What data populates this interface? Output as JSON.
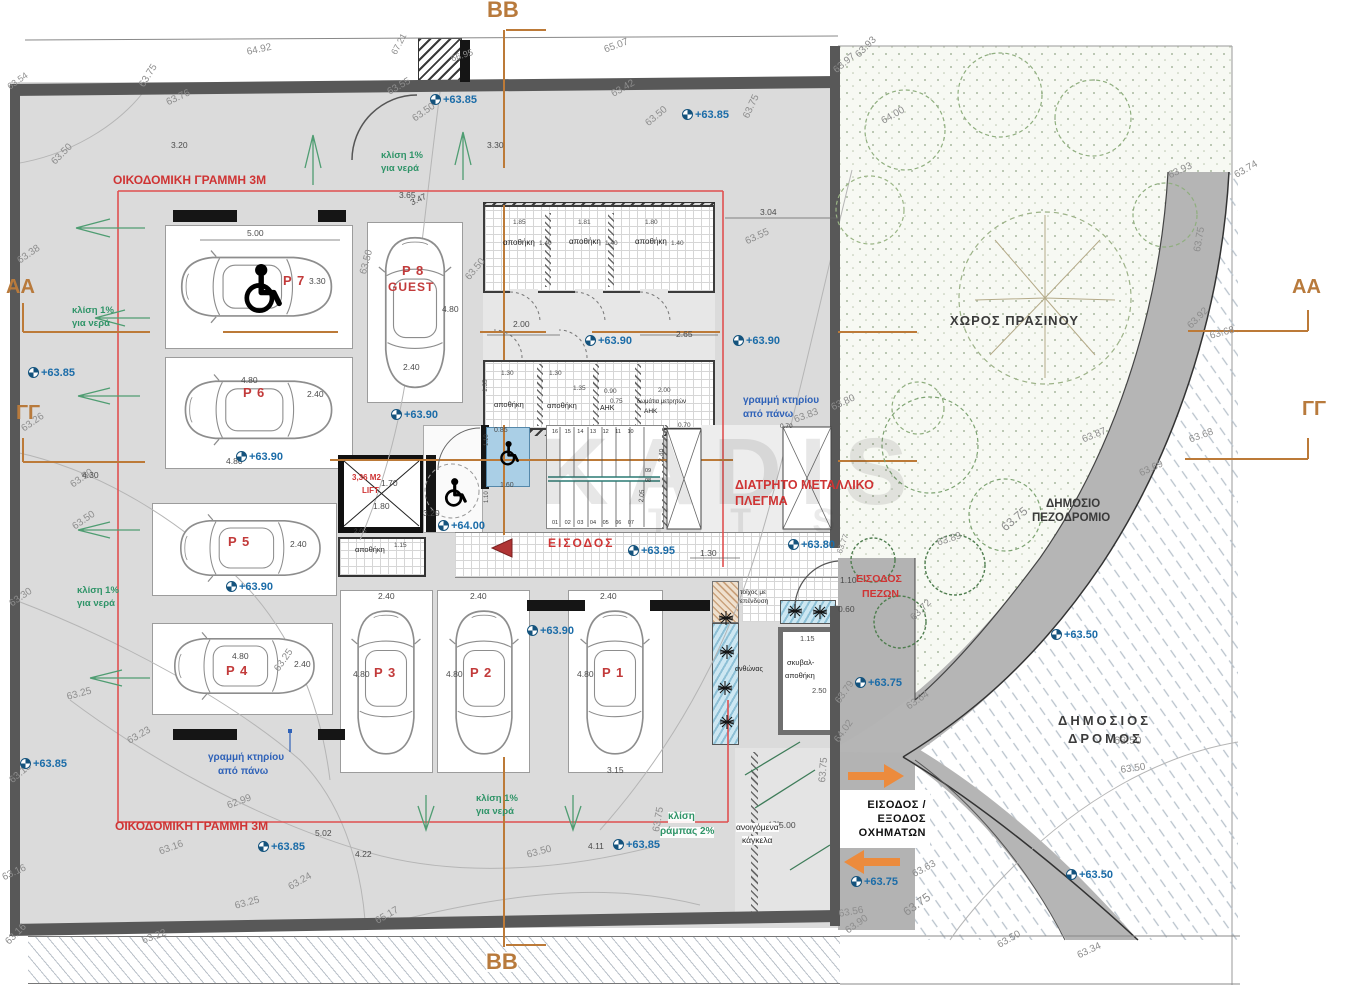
{
  "watermark": {
    "l1": "KADIS",
    "l2": "T T S"
  },
  "veh": [
    "ΕΙΣΟΔΟΣ /",
    "ΕΞΟΔΟΣ",
    "ΟΧΗΜΑΤΩΝ"
  ],
  "stairs": {
    "top": "16 15 14 13 12 11 10",
    "bottom": "01 02 03 04 05 06 07",
    "m1": "09",
    "m2": "08"
  },
  "sections": [
    {
      "t": "BB",
      "x": 487,
      "y": 0
    },
    {
      "t": "BB",
      "x": 486,
      "y": 952,
      "bg": 1
    },
    {
      "t": "ΑΑ",
      "x": 6,
      "y": 278,
      "fs": 20
    },
    {
      "t": "AA",
      "x": 1292,
      "y": 278,
      "fs": 20
    },
    {
      "t": "ΓΓ",
      "x": 16,
      "y": 404,
      "fs": 20
    },
    {
      "t": "ΓΓ",
      "x": 1302,
      "y": 400,
      "fs": 20
    }
  ],
  "areas": [
    {
      "t": "ΧΩΡΟΣ ΠΡΑΣΙΝΟΥ",
      "x": 950,
      "y": 314,
      "fs": 13,
      "ls": 1
    },
    {
      "t": "ΔΗΜΟΣΙΟ",
      "x": 1046,
      "y": 498,
      "fs": 11.5
    },
    {
      "t": "ΠΕΖΟΔΡΟΜΙΟ",
      "x": 1032,
      "y": 512,
      "fs": 11.5
    },
    {
      "t": "ΔΗΜΟΣΙΟΣ",
      "x": 1058,
      "y": 714,
      "fs": 13,
      "ls": 3
    },
    {
      "t": "ΔΡΟΜΟΣ",
      "x": 1068,
      "y": 732,
      "fs": 13,
      "ls": 3
    }
  ],
  "plabels": [
    {
      "t": "P 7",
      "x": 283,
      "y": 274
    },
    {
      "t": "P 6",
      "x": 243,
      "y": 386
    },
    {
      "t": "P 8",
      "x": 402,
      "y": 264
    },
    {
      "t": "GUEST",
      "x": 388,
      "y": 281,
      "fs": 12
    },
    {
      "t": "P 5",
      "x": 228,
      "y": 535
    },
    {
      "t": "P 4",
      "x": 226,
      "y": 664
    },
    {
      "t": "P 3",
      "x": 374,
      "y": 666
    },
    {
      "t": "P 2",
      "x": 470,
      "y": 666
    },
    {
      "t": "P 1",
      "x": 602,
      "y": 666
    }
  ],
  "red": [
    {
      "t": "ΟΙΚΟΔΟΜΙΚΗ ΓΡΑΜΜΗ 3Μ",
      "x": 113,
      "y": 174,
      "fs": 12
    },
    {
      "t": "ΟΙΚΟΔΟΜΙΚΗ ΓΡΑΜΜΗ 3Μ",
      "x": 115,
      "y": 820,
      "fs": 12
    },
    {
      "t": "ΔΙΑΤΡΗΤΟ ΜΕΤΑΛΛΙΚΟ",
      "x": 735,
      "y": 479,
      "fs": 12.5
    },
    {
      "t": "ΠΛΕΓΜΑ",
      "x": 735,
      "y": 495,
      "fs": 12.5
    },
    {
      "t": "ΕΙΣΟΔΟΣ",
      "x": 548,
      "y": 537,
      "fs": 12,
      "ls": 2
    },
    {
      "t": "ΕΙΣΟΔΟΣ",
      "x": 856,
      "y": 574,
      "fs": 10.5
    },
    {
      "t": "ΠΕΖΩΝ",
      "x": 862,
      "y": 589,
      "fs": 10.5
    },
    {
      "t": "3,36 M2",
      "x": 352,
      "y": 474,
      "fs": 8
    },
    {
      "t": "LIFT",
      "x": 362,
      "y": 487,
      "fs": 8
    }
  ],
  "blue": [
    {
      "t": "γραμμή κτηρίου",
      "x": 743,
      "y": 396
    },
    {
      "t": "από πάνω",
      "x": 743,
      "y": 410
    },
    {
      "t": "γραμμή κτηρίου",
      "x": 208,
      "y": 753
    },
    {
      "t": "από πάνω",
      "x": 218,
      "y": 767
    }
  ],
  "green": [
    {
      "t": "κλίση 1%",
      "x": 381,
      "y": 151
    },
    {
      "t": "για νερά",
      "x": 381,
      "y": 164
    },
    {
      "t": "κλίση 1%",
      "x": 72,
      "y": 306
    },
    {
      "t": "για νερά",
      "x": 72,
      "y": 319
    },
    {
      "t": "κλίση 1%",
      "x": 77,
      "y": 586
    },
    {
      "t": "για νερά",
      "x": 77,
      "y": 599
    },
    {
      "t": "κλίση 1%",
      "x": 476,
      "y": 794
    },
    {
      "t": "για νερά",
      "x": 476,
      "y": 807
    },
    {
      "t": "κλίση",
      "x": 668,
      "y": 812,
      "fs": 10,
      "bg": 1
    },
    {
      "t": "ράμπας 2%",
      "x": 660,
      "y": 827,
      "fs": 10,
      "bg": 1
    }
  ],
  "rooms": [
    {
      "t": "αποθήκη",
      "x": 503,
      "y": 239
    },
    {
      "t": "αποθήκη",
      "x": 569,
      "y": 238
    },
    {
      "t": "αποθήκη",
      "x": 635,
      "y": 238
    },
    {
      "t": "αποθήκη",
      "x": 494,
      "y": 401,
      "fs": 7.5
    },
    {
      "t": "αποθήκη",
      "x": 547,
      "y": 402,
      "fs": 7.5
    },
    {
      "t": "ΑΗΚ",
      "x": 600,
      "y": 405,
      "fs": 7
    },
    {
      "t": "δωμάτια μετρητών",
      "x": 637,
      "y": 399,
      "fs": 6
    },
    {
      "t": "ΑΗΚ",
      "x": 644,
      "y": 409,
      "fs": 6.5
    },
    {
      "t": "αποθήκη",
      "x": 355,
      "y": 546,
      "fs": 7.5
    },
    {
      "t": "σκυβαλ-",
      "x": 787,
      "y": 659,
      "fs": 7.5
    },
    {
      "t": "αποθήκη",
      "x": 785,
      "y": 672,
      "fs": 7.5
    },
    {
      "t": "ανθώνας",
      "x": 735,
      "y": 666,
      "fs": 7
    },
    {
      "t": "τοίχος με",
      "x": 740,
      "y": 590,
      "fs": 6.5
    },
    {
      "t": "επένδυση",
      "x": 740,
      "y": 599,
      "fs": 6.5
    },
    {
      "t": "ανοιγόμενα",
      "x": 736,
      "y": 823,
      "fs": 8.5,
      "bg": 1
    },
    {
      "t": "κάγκελα",
      "x": 742,
      "y": 836,
      "fs": 8.5,
      "bg": 1
    }
  ],
  "marks": [
    {
      "t": "+63.85",
      "x": 430,
      "y": 94
    },
    {
      "t": "+63.85",
      "x": 682,
      "y": 109
    },
    {
      "t": "+63.85",
      "x": 28,
      "y": 367
    },
    {
      "t": "+63.90",
      "x": 585,
      "y": 335
    },
    {
      "t": "+63.90",
      "x": 733,
      "y": 335
    },
    {
      "t": "+63.90",
      "x": 391,
      "y": 409
    },
    {
      "t": "+63.90",
      "x": 236,
      "y": 451
    },
    {
      "t": "+64.00",
      "x": 438,
      "y": 520
    },
    {
      "t": "+63.95",
      "x": 628,
      "y": 545
    },
    {
      "t": "+63.80",
      "x": 788,
      "y": 539
    },
    {
      "t": "+63.90",
      "x": 527,
      "y": 625
    },
    {
      "t": "+63.90",
      "x": 226,
      "y": 581
    },
    {
      "t": "+63.75",
      "x": 855,
      "y": 677
    },
    {
      "t": "+63.75",
      "x": 851,
      "y": 876
    },
    {
      "t": "+63.50",
      "x": 1051,
      "y": 629
    },
    {
      "t": "+63.50",
      "x": 1066,
      "y": 869
    },
    {
      "t": "+63.85",
      "x": 20,
      "y": 758
    },
    {
      "t": "+63.85",
      "x": 258,
      "y": 841
    },
    {
      "t": "+63.85",
      "x": 613,
      "y": 839
    }
  ],
  "gray": [
    {
      "t": "64.92",
      "x": 246,
      "y": 48,
      "r": -12
    },
    {
      "t": "65.07",
      "x": 603,
      "y": 46,
      "r": -20
    },
    {
      "t": "67.21",
      "x": 390,
      "y": 52,
      "r": -62,
      "fs": 9
    },
    {
      "t": "66.95",
      "x": 450,
      "y": 55,
      "r": -18,
      "fs": 9
    },
    {
      "t": "63.75",
      "x": 138,
      "y": 84,
      "r": -58
    },
    {
      "t": "63.76",
      "x": 165,
      "y": 99,
      "r": -25
    },
    {
      "t": "63.54",
      "x": 6,
      "y": 84,
      "r": -35,
      "fs": 9
    },
    {
      "t": "63.50",
      "x": 50,
      "y": 160,
      "r": -45
    },
    {
      "t": "63.55",
      "x": 386,
      "y": 89,
      "r": -30
    },
    {
      "t": "63.50",
      "x": 411,
      "y": 116,
      "r": -35
    },
    {
      "t": "63.42",
      "x": 610,
      "y": 91,
      "r": -30
    },
    {
      "t": "63.50",
      "x": 644,
      "y": 121,
      "r": -40
    },
    {
      "t": "63.75",
      "x": 742,
      "y": 116,
      "r": -65
    },
    {
      "t": "63.93",
      "x": 854,
      "y": 53,
      "r": -45
    },
    {
      "t": "63.97",
      "x": 832,
      "y": 68,
      "r": -40
    },
    {
      "t": "64.00",
      "x": 880,
      "y": 118,
      "r": -30
    },
    {
      "t": "63.93",
      "x": 1167,
      "y": 172,
      "r": -25
    },
    {
      "t": "63.74",
      "x": 1233,
      "y": 172,
      "r": -30
    },
    {
      "t": "63.75",
      "x": 1193,
      "y": 251,
      "r": -80
    },
    {
      "t": "63.92",
      "x": 1186,
      "y": 324,
      "r": -45
    },
    {
      "t": "63.68",
      "x": 1209,
      "y": 332,
      "r": -15
    },
    {
      "t": "63.87",
      "x": 1081,
      "y": 436,
      "r": -22
    },
    {
      "t": "63.68",
      "x": 1188,
      "y": 436,
      "r": -20
    },
    {
      "t": "63.69",
      "x": 1138,
      "y": 470,
      "r": -25
    },
    {
      "t": "63.75",
      "x": 999,
      "y": 524,
      "r": -40,
      "fs": 12
    },
    {
      "t": "63.89",
      "x": 936,
      "y": 539,
      "r": -18
    },
    {
      "t": "63.72",
      "x": 909,
      "y": 616,
      "r": -45
    },
    {
      "t": "63.64",
      "x": 905,
      "y": 704,
      "r": -35
    },
    {
      "t": "63.50",
      "x": 1114,
      "y": 736,
      "fs": 11
    },
    {
      "t": "63.80",
      "x": 830,
      "y": 404,
      "r": -25
    },
    {
      "t": "63.83",
      "x": 793,
      "y": 416,
      "r": -20
    },
    {
      "t": "63.77",
      "x": 836,
      "y": 552,
      "r": -70,
      "fs": 8
    },
    {
      "t": "63.38",
      "x": 16,
      "y": 258,
      "r": -35
    },
    {
      "t": "63.26",
      "x": 20,
      "y": 426,
      "r": -35
    },
    {
      "t": "63.50",
      "x": 69,
      "y": 482,
      "r": -35
    },
    {
      "t": "63.50",
      "x": 71,
      "y": 524,
      "r": -35
    },
    {
      "t": "63.30",
      "x": 8,
      "y": 601,
      "r": -35
    },
    {
      "t": "63.25",
      "x": 66,
      "y": 693,
      "r": -15
    },
    {
      "t": "63.23",
      "x": 126,
      "y": 738,
      "r": -30
    },
    {
      "t": "62.99",
      "x": 226,
      "y": 802,
      "r": -20
    },
    {
      "t": "63.16",
      "x": 158,
      "y": 848,
      "r": -20
    },
    {
      "t": "63.24",
      "x": 287,
      "y": 884,
      "r": -30
    },
    {
      "t": "63.25",
      "x": 234,
      "y": 902,
      "r": -15
    },
    {
      "t": "63.22",
      "x": 141,
      "y": 937,
      "r": -20
    },
    {
      "t": "63.16",
      "x": 4,
      "y": 940,
      "r": -45
    },
    {
      "t": "63.18",
      "x": 8,
      "y": 778,
      "r": -40
    },
    {
      "t": "63.16",
      "x": 1,
      "y": 874,
      "r": -25
    },
    {
      "t": "63.25",
      "x": 273,
      "y": 668,
      "r": -55
    },
    {
      "t": "63.75",
      "x": 652,
      "y": 831,
      "r": -80
    },
    {
      "t": "63.50",
      "x": 526,
      "y": 851,
      "r": -15
    },
    {
      "t": "65.17",
      "x": 374,
      "y": 918,
      "r": -30
    },
    {
      "t": "63.56",
      "x": 838,
      "y": 910,
      "r": -10
    },
    {
      "t": "63.90",
      "x": 844,
      "y": 928,
      "r": -35
    },
    {
      "t": "63.63",
      "x": 911,
      "y": 871,
      "r": -28
    },
    {
      "t": "63.50",
      "x": 1120,
      "y": 766,
      "r": -8
    },
    {
      "t": "63.50",
      "x": 996,
      "y": 942,
      "r": -30
    },
    {
      "t": "63.75",
      "x": 901,
      "y": 908,
      "r": -35,
      "fs": 12
    },
    {
      "t": "63.34",
      "x": 1076,
      "y": 952,
      "r": -25
    },
    {
      "t": "64.02",
      "x": 833,
      "y": 739,
      "r": -55
    },
    {
      "t": "63.79",
      "x": 834,
      "y": 700,
      "r": -55
    },
    {
      "t": "63.75",
      "x": 818,
      "y": 782,
      "r": -85
    },
    {
      "t": "63.50",
      "x": 359,
      "y": 273,
      "r": -75
    },
    {
      "t": "63.50",
      "x": 464,
      "y": 276,
      "r": -50
    },
    {
      "t": "63.55",
      "x": 744,
      "y": 238,
      "r": -25
    }
  ],
  "dims": [
    {
      "t": "3.20",
      "x": 171,
      "y": 141
    },
    {
      "t": "3.30",
      "x": 487,
      "y": 141
    },
    {
      "t": "5.00",
      "x": 247,
      "y": 229
    },
    {
      "t": "3.30",
      "x": 309,
      "y": 277
    },
    {
      "t": "3.65",
      "x": 399,
      "y": 191
    },
    {
      "t": "3.47",
      "x": 409,
      "y": 199,
      "r": -25
    },
    {
      "t": "4.80",
      "x": 442,
      "y": 305
    },
    {
      "t": "2.40",
      "x": 403,
      "y": 363
    },
    {
      "t": "4.80",
      "x": 241,
      "y": 376
    },
    {
      "t": "2.40",
      "x": 307,
      "y": 390
    },
    {
      "t": "3.04",
      "x": 760,
      "y": 208
    },
    {
      "t": "2.00",
      "x": 513,
      "y": 320
    },
    {
      "t": "2.65",
      "x": 676,
      "y": 330
    },
    {
      "t": "1.85",
      "x": 513,
      "y": 220,
      "fs": 6.5
    },
    {
      "t": "1.81",
      "x": 578,
      "y": 220,
      "fs": 6.5
    },
    {
      "t": "1.80",
      "x": 645,
      "y": 220,
      "fs": 6.5
    },
    {
      "t": "1.40",
      "x": 539,
      "y": 241,
      "fs": 6.5
    },
    {
      "t": "1.40",
      "x": 605,
      "y": 241,
      "fs": 6.5
    },
    {
      "t": "1.40",
      "x": 671,
      "y": 241,
      "fs": 6.5
    },
    {
      "t": "1.30",
      "x": 501,
      "y": 371,
      "fs": 6.5
    },
    {
      "t": "1.30",
      "x": 549,
      "y": 371,
      "fs": 6.5
    },
    {
      "t": "1.35",
      "x": 483,
      "y": 392,
      "fs": 6.5,
      "r": -90
    },
    {
      "t": "1.35",
      "x": 573,
      "y": 386,
      "fs": 6.5
    },
    {
      "t": "0.90",
      "x": 604,
      "y": 389,
      "fs": 6.5
    },
    {
      "t": "0.75",
      "x": 610,
      "y": 399,
      "fs": 6.5
    },
    {
      "t": "2.00",
      "x": 658,
      "y": 388,
      "fs": 6.5
    },
    {
      "t": "4.80",
      "x": 226,
      "y": 457
    },
    {
      "t": "2.40",
      "x": 290,
      "y": 540
    },
    {
      "t": "4.80",
      "x": 232,
      "y": 652
    },
    {
      "t": "2.40",
      "x": 294,
      "y": 660
    },
    {
      "t": "2.40",
      "x": 378,
      "y": 592
    },
    {
      "t": "2.40",
      "x": 470,
      "y": 592
    },
    {
      "t": "2.40",
      "x": 600,
      "y": 592
    },
    {
      "t": "4.80",
      "x": 353,
      "y": 670
    },
    {
      "t": "4.80",
      "x": 446,
      "y": 670
    },
    {
      "t": "4.80",
      "x": 577,
      "y": 670
    },
    {
      "t": "3.15",
      "x": 607,
      "y": 766
    },
    {
      "t": "1.30",
      "x": 700,
      "y": 549
    },
    {
      "t": "1.10",
      "x": 840,
      "y": 576
    },
    {
      "t": "0.60",
      "x": 838,
      "y": 605
    },
    {
      "t": "1.15",
      "x": 800,
      "y": 635,
      "fs": 7.5
    },
    {
      "t": "2.50",
      "x": 812,
      "y": 687,
      "fs": 7.5
    },
    {
      "t": "1.70",
      "x": 381,
      "y": 479
    },
    {
      "t": "1.80",
      "x": 373,
      "y": 502
    },
    {
      "t": "3.20",
      "x": 423,
      "y": 509
    },
    {
      "t": "0.85",
      "x": 494,
      "y": 427,
      "fs": 7
    },
    {
      "t": "1.60",
      "x": 500,
      "y": 482,
      "fs": 7
    },
    {
      "t": "0.70",
      "x": 678,
      "y": 423,
      "fs": 6.5
    },
    {
      "t": "0.70",
      "x": 780,
      "y": 424,
      "fs": 6.5
    },
    {
      "t": "2.40",
      "x": 658,
      "y": 462,
      "r": -85,
      "fs": 7
    },
    {
      "t": "2.05",
      "x": 639,
      "y": 502,
      "r": -85,
      "fs": 6.5
    },
    {
      "t": "1.10",
      "x": 484,
      "y": 446,
      "r": -90,
      "fs": 6
    },
    {
      "t": "1.10",
      "x": 484,
      "y": 503,
      "r": -90,
      "fs": 6
    },
    {
      "t": "2.05",
      "x": 354,
      "y": 529,
      "fs": 6.5
    },
    {
      "t": "1.15",
      "x": 394,
      "y": 543,
      "fs": 6.5
    },
    {
      "t": "5.00",
      "x": 779,
      "y": 821
    },
    {
      "t": "4.78",
      "x": 768,
      "y": 822,
      "fs": 6
    },
    {
      "t": "5.02",
      "x": 315,
      "y": 829
    },
    {
      "t": "4.22",
      "x": 355,
      "y": 850
    },
    {
      "t": "4.11",
      "x": 588,
      "y": 842
    },
    {
      "t": "4.30",
      "x": 82,
      "y": 471
    }
  ]
}
